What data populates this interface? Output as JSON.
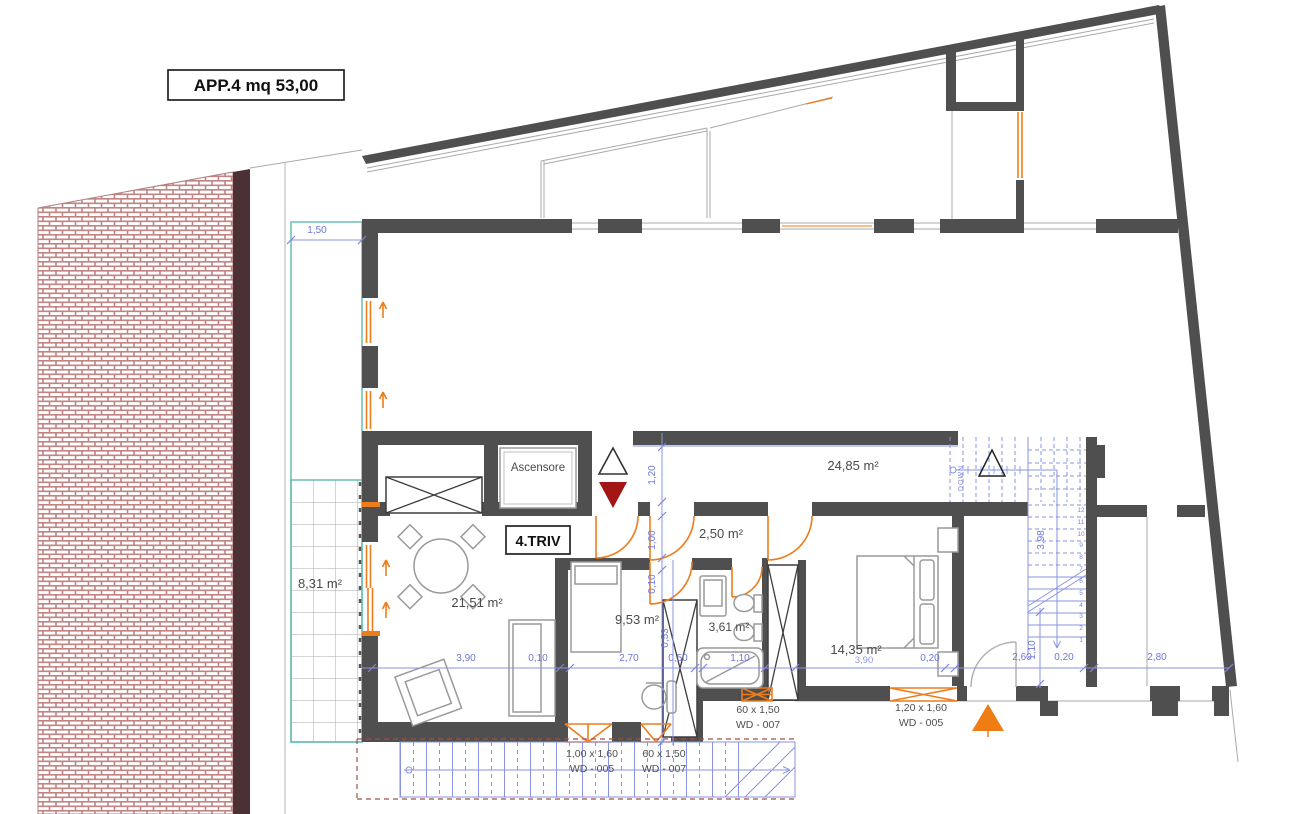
{
  "title": "APP.4 mq 53,00",
  "labels": {
    "elevator": "Ascensore",
    "apartment": "4.TRIV",
    "stairs_down": "DOWN"
  },
  "areas": {
    "terrace": "8,31 m²",
    "living": "21,51 m²",
    "bedroom1": "9,53 m²",
    "bathroom": "3,61 m²",
    "hallway": "2,50 m²",
    "upper_room": "24,85 m²",
    "bedroom2": "14,35 m²"
  },
  "dims": {
    "terrace_w": "1,50",
    "living_w": "3,90",
    "wall_a": "0,10",
    "bedroom1_w": "2,70",
    "shaft_w": "0,50",
    "shaft_h": "0,53",
    "bath_w": "1,10",
    "bedroom2_w": "3,90",
    "wall_b": "0,20",
    "stair_w": "2,60",
    "stair_v": "1,10",
    "wall_c": "0,20",
    "right_room_w": "2,80",
    "corridor_h": "1,20",
    "hallway_h": "1,00",
    "wall_d": "0,10",
    "flight_len": "3,98"
  },
  "windows": [
    {
      "size": "1,00 x 1,60",
      "code": "WD - 005"
    },
    {
      "size": "60 x 1,50",
      "code": "WD - 007"
    },
    {
      "size": "60 x 1,50",
      "code": "WD - 007"
    },
    {
      "size": "1,20 x 1,60",
      "code": "WD - 005"
    }
  ],
  "stairs": {
    "numbers": [
      "1",
      "2",
      "3",
      "4",
      "5",
      "6",
      "7",
      "8",
      "9",
      "10",
      "11",
      "12"
    ]
  },
  "colors": {
    "wall": "#4f4f4f",
    "orange": "#ee7c1b",
    "dimension_blue": "#6d78d8",
    "teal": "#5ebbaa",
    "brick": "#c08484",
    "band": "#4c3134",
    "red_triangle": "#a31616",
    "orange_triangle": "#ee7d15"
  }
}
